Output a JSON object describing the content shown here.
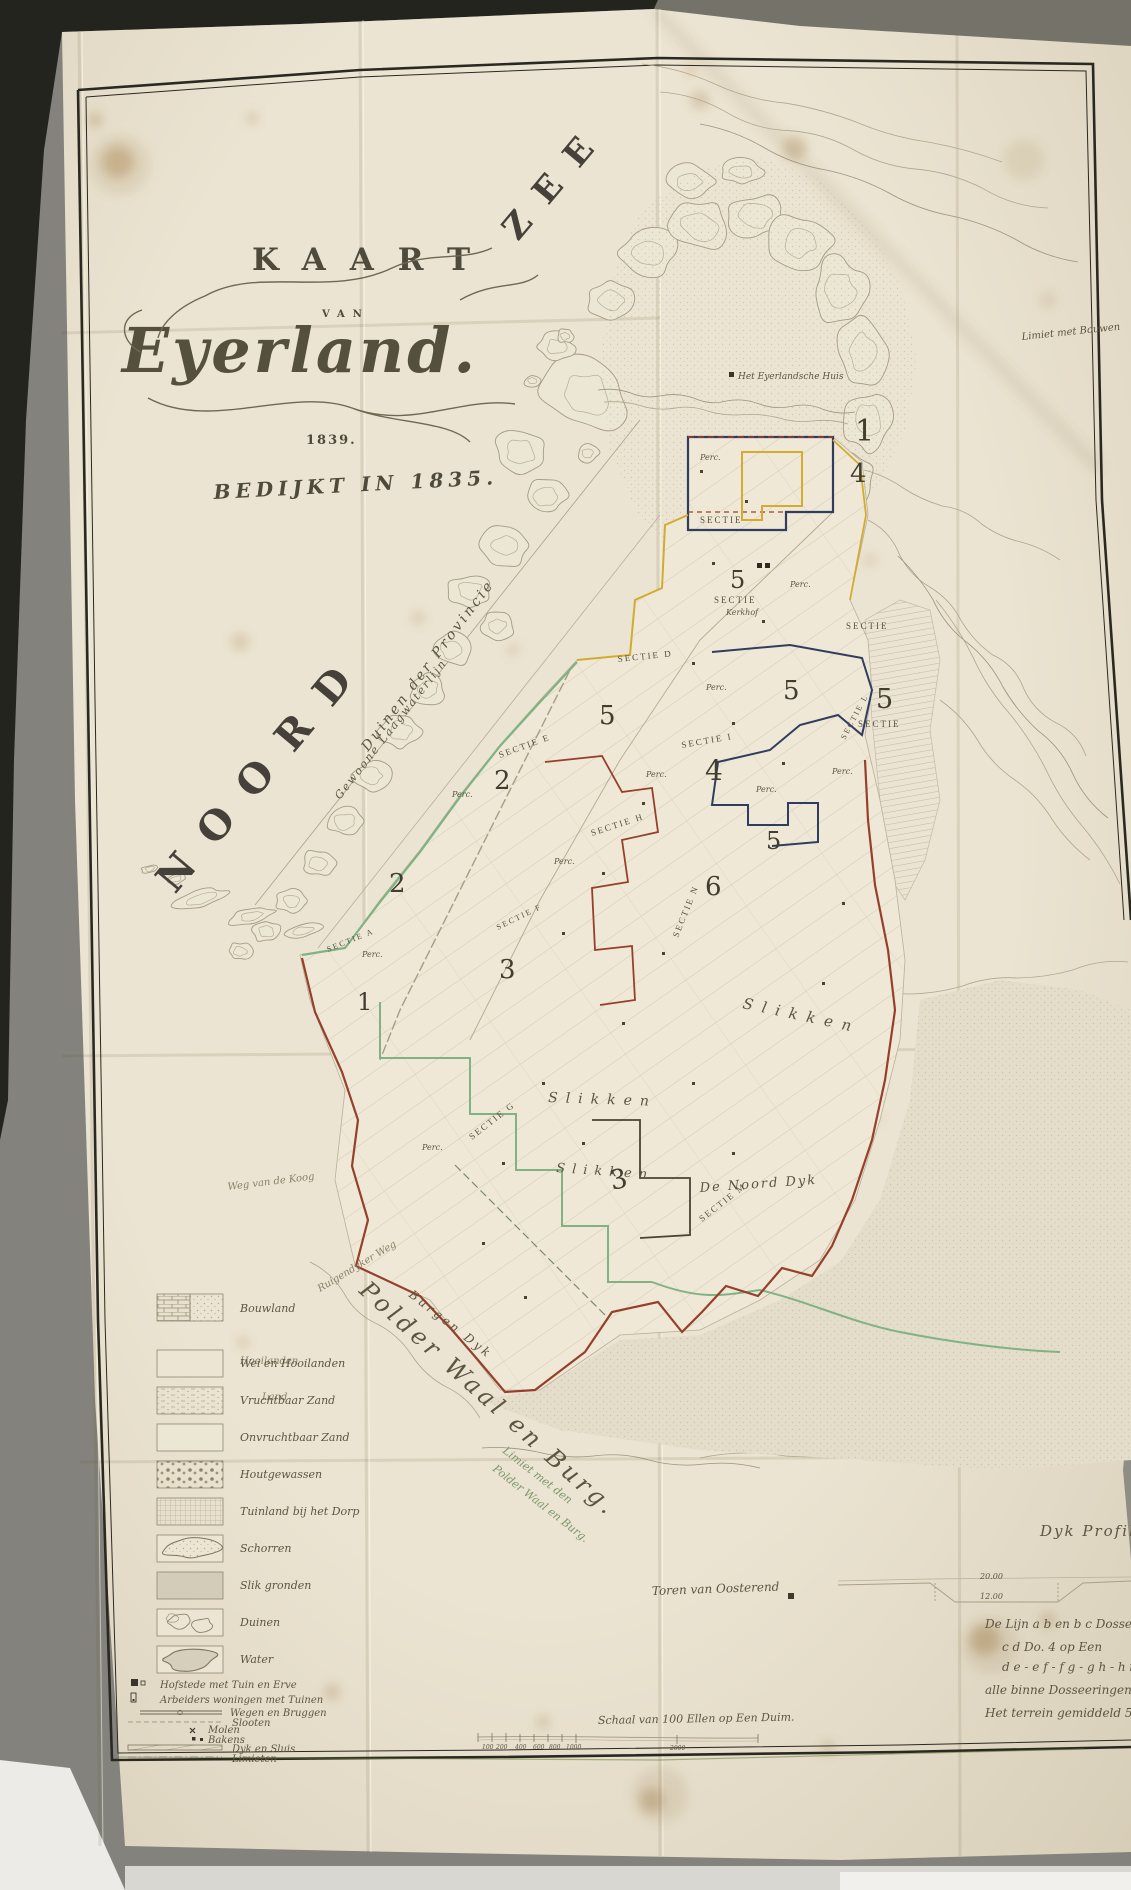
{
  "title_block": {
    "kaart": "KAART",
    "van": "VAN",
    "name": "Eyerland.",
    "year": "1839.",
    "subtitle": "BEDIJKT IN 1835."
  },
  "sea": {
    "noord": "NOORD",
    "zee": "ZEE"
  },
  "coast_labels": {
    "gewoone_laagwaterlijn": "Gewoone Laagwaterlijn",
    "duinen_der_provincie": "Duinen der Provincie",
    "limiet_bouwen": "Limiet met Bouwen",
    "eyerlandsche_huis": "Het Eyerlandsche Huis",
    "slikken_a": "Slikken",
    "slikken_b": "Slikken",
    "slikken_c": "Slikken",
    "de_noord_dyk": "De Noord Dyk",
    "limiet_1": "Limiet met den",
    "limiet_2": "Polder Waal en Burg.",
    "polder_waal_en_burg": "Polder Waal en Burg.",
    "burgen_dyk": "Burgen Dyk",
    "ruigendyker_weg": "Ruigendyker Weg",
    "weg_van_de_koog": "Weg van de Koog",
    "hooilanden": "Hooilanden",
    "land": "Land",
    "toren_van_oosterend": "Toren van Oosterend"
  },
  "sections": {
    "perc": "Perc.",
    "kerkhof": "Kerkhof",
    "numbers": {
      "n1a": "1",
      "n4a": "4",
      "n5a": "5",
      "n5b": "5",
      "n5c": "5",
      "n5d": "5",
      "n4b": "4",
      "n5e": "5",
      "n6": "6",
      "n2a": "2",
      "n2b": "2",
      "n3a": "3",
      "n1b": "1",
      "n3b": "3"
    },
    "labels": [
      {
        "t": "SECTIE"
      },
      {
        "t": "SECTIE"
      },
      {
        "t": "SECTIE D"
      },
      {
        "t": "SECTIE"
      },
      {
        "t": "SECTIE"
      },
      {
        "t": "SECTIE L"
      },
      {
        "t": "SECTIE I"
      },
      {
        "t": "SECTIE H"
      },
      {
        "t": "SECTIE N"
      },
      {
        "t": "SECTIE E"
      },
      {
        "t": "SECTIE A"
      },
      {
        "t": "SECTIE F"
      },
      {
        "t": "SECTIE G"
      },
      {
        "t": "SECTIE M"
      }
    ]
  },
  "legend": {
    "items": [
      {
        "label": "Bouwland"
      },
      {
        "label": "Wei en Hooilanden"
      },
      {
        "label": "Vruchtbaar Zand"
      },
      {
        "label": "Onvruchtbaar Zand"
      },
      {
        "label": "Houtgewassen"
      },
      {
        "label": "Tuinland bij het Dorp"
      },
      {
        "label": "Schorren"
      },
      {
        "label": "Slik gronden"
      },
      {
        "label": "Duinen"
      },
      {
        "label": "Water"
      },
      {
        "label": "Hofstede met Tuin en Erve"
      },
      {
        "label": "Arbeiders woningen met Tuinen"
      },
      {
        "label": "Wegen en Bruggen"
      },
      {
        "label": "Slooten"
      },
      {
        "label": "Molen"
      },
      {
        "label": "Bakens"
      },
      {
        "label": "Dyk en Sluis"
      },
      {
        "label": "Limieten"
      }
    ]
  },
  "profile": {
    "title": "Dyk Profil.",
    "v_top": "20.00",
    "v_bottom": "12.00",
    "line1": "De Lijn a b en b c Dosseering 6 op Een",
    "line2": "c d Do. 4 op Een",
    "line3": "d e - e f - f g - g h - h i - i k",
    "line4": "alle binne Dosseeringen 2 op Een.",
    "line5": "Het terrein gemiddeld 50 dm + V"
  },
  "scale": {
    "caption": "Schaal van 100 Ellen op Een Duim.",
    "ticks": [
      "100",
      "200",
      "400",
      "600",
      "800",
      "1000",
      "2000"
    ]
  },
  "colors": {
    "paper": "#ebe4d2",
    "border": "#2a2921",
    "yellow": "#d1ac2e",
    "red": "#96402c",
    "green": "#7fb383",
    "navy": "#323c5e"
  }
}
